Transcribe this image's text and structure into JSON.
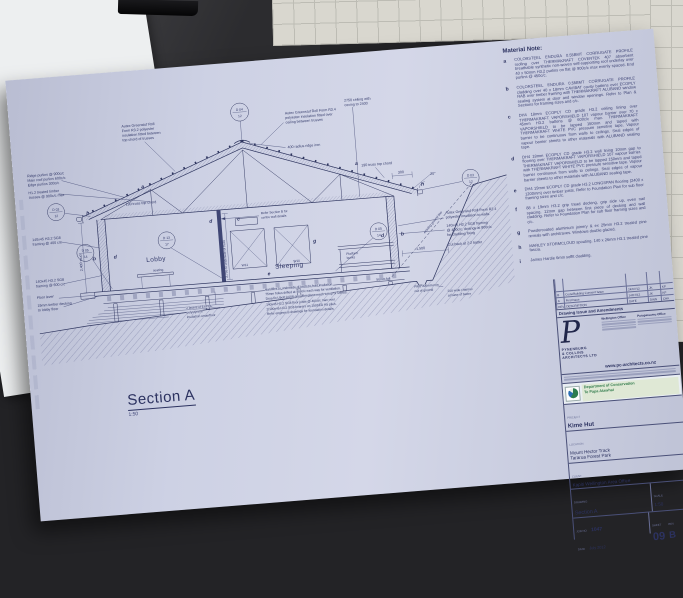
{
  "sheet": {
    "material_note": {
      "title": "Material Note:",
      "items": [
        {
          "key": "a",
          "text": "COLORSTEEL ENDURA 0.55BMT CORRUGATE PROFILE roofing over THERMAKRAFT COVERTEK 407 absorbent breathable synthetic non-woven self-supporting roof underlay over 40 x 50mm H3.2 purlins on flat @ 900c/c max evenly spaced. End purlins @ 450c/c."
        },
        {
          "key": "b",
          "text": "COLORSTEEL ENDURA 0.55BMT CORRUGATE PROFILE cladding over 40 x 18mm CAVIBAT cavity battens over ECOPLY RAB over timber framing with THERMAKRAFT ALUBAND window sealing system at door and window openings. Refer to Plan & Sections for framing sizes and c/c."
        },
        {
          "key": "c",
          "text": "DH4 18mm ECOPLY CD grade H3.2 ceiling lining over THERMAKRAFT VAPORSHIELD 107 vapour barrier over 70 x 45mm H3.2 battens @ 600c/c max. THERMAKRAFT VAPORSHIELD to be lapped 150mm and taped with THERMAKRAFT WHITE PVC pressure sensitive tape. Vapour barrier to be continuous from walls to ceilings. Seal edges of vapour barrier sheets to other materials with ALUBAND sealing tape."
        },
        {
          "key": "d",
          "text": "DH4 18mm ECOPLY CD grade H3.2 wall lining 10mm gap to flooring over THERMAKRAFT VAPORSHIELD 107 vapour barrier. THERMAKRAFT VAPORSHIELD to be lapped 150mm and taped with THERMAKRAFT WHITE PVC pressure sensitive tape. Vapour barrier continuous from walls to ceilings. Seal edges of vapour barrier sheets to other materials with ALUBAND sealing tape."
        },
        {
          "key": "e",
          "text": "DH4 19mm ECOPLY CD grade H3.2 LONGSPAN flooring (2400 x 1200mm) over timber joists. Refer to Foundation Plan for sub floor framing sizes and c/c."
        },
        {
          "key": "f",
          "text": "88 x 19mm H3.2 grip tread decking, grip side up, even nail spacing. 12mm gap between first piece of decking and wall cladding. Refer to Foundation Plan for sub floor framing sizes and c/c."
        },
        {
          "key": "g",
          "text": "Powdercoated aluminium joinery & ex 25mm H3.2 treated pine reveals with architraves. Windows double glazed."
        },
        {
          "key": "h",
          "text": "MARLEY STORMCLOUD spouting. 140 x 26mm H3.1 treated pine fascia."
        },
        {
          "key": "i",
          "text": "James Hardie 6mm soffit cladding."
        }
      ]
    },
    "drawing": {
      "section_title": "Section A",
      "section_scale": "1:50",
      "rooms": {
        "lobby": "Lobby",
        "sleeping": "Sleeping",
        "seating": "seating",
        "bunks": [
          "Platform",
          "bunks"
        ]
      },
      "windows": {
        "w11": "W11",
        "w10": "W10"
      },
      "letters": {
        "a": "a",
        "b": "b",
        "c": "c",
        "d": "d",
        "e": "e",
        "g": "g",
        "h": "h"
      },
      "circles": [
        {
          "top": "D 04",
          "bot": "12"
        },
        {
          "top": "D 03",
          "bot": "12"
        },
        {
          "top": "D 03",
          "bot": "12"
        },
        {
          "top": "D 05",
          "bot": "14"
        },
        {
          "top": "D 13",
          "bot": "17"
        },
        {
          "top": "D 05",
          "bot": "14"
        }
      ],
      "callouts": {
        "ridge_purlins": [
          "Ridge purlins @ 900c/c",
          "Main roof purlins 600c/c",
          "Edge purlins 300c/c"
        ],
        "trusses": [
          "H1.2 treated timber",
          "trusses @ 900c/c max"
        ],
        "truss_chord_left": "190 truss top chord",
        "truss_chord_right": "190 truss top chord",
        "framing400": [
          "140x45 H3.2 SG8",
          "framing @ 400 c/c"
        ],
        "framing600": [
          "140x45 H3.2 SG8",
          "framing @ 600 c/c"
        ],
        "floor_level": "Floor level",
        "decking": [
          "19mm timber decking",
          "to lobby floor"
        ],
        "insul_top_left": [
          "Autex Greenstuf Roll",
          "Form R3.2 polyester",
          "insulation fitted between",
          "top chord of trusses"
        ],
        "insul_top_right": [
          "Autex Greenstuf Roll Form R3.4",
          "polyester insulation fitted over",
          "ceiling between trusses"
        ],
        "ridge_iron": "400 radius ridge iron",
        "ceiling_note": [
          "2750 ceiling with",
          "coving to 2400"
        ],
        "insul_walls": [
          "Autex Greenstuf Roll Form R2.4",
          "polyester insulation to walls"
        ],
        "framing_cladding": [
          "140x45 H3.2 SG8 framing",
          "@ 400c/c, dwangs at 800c/c",
          "for cladding fixing"
        ],
        "cutback": "Cut back at 2:2 batter",
        "existing_ground": "existing ground line",
        "fall": "50mm fall",
        "piles_note": [
          "Piles 300mm min",
          "out of ground"
        ],
        "channel": [
          "200 wide channel",
          "at base of batter"
        ],
        "refer_b": [
          "Refer Section B for",
          "centre wall details"
        ],
        "expol": [
          "2 layers of EXPOL",
          "polystyrene",
          "insulation underfloor"
        ],
        "bottom_notes": [
          "Hardiflex to underside of joists to hold insulation.",
          "75mm holes drilled at 400c/c each way for ventilation.",
          "Drua fix Ubolt 0.008 grey fibreglass mesh to top of sheets.",
          "140x45 H3.2 SG8 floor joists @ 400c/c max over",
          "2/190x45 H3.2 SG8 bearers on 150SED H5 piles.",
          "Refer engineers drawings for foundation details."
        ]
      },
      "dims": {
        "stud": "2,400 stud",
        "truss": "2,755 to underside of truss",
        "m1500": "1,500",
        "m300": "300",
        "pitch": "20°"
      }
    },
    "title_block": {
      "rev_header": [
        "REV",
        "DESCRIPTION",
        "DATE",
        "DWN",
        "CHK"
      ],
      "revisions": [
        {
          "rev": "B",
          "desc": "Code/Building Consent Issue",
          "date": "24/07/12",
          "by": "JK",
          "chk": "KP"
        },
        {
          "rev": "A",
          "desc": "First Issue",
          "date": "14/07/12",
          "by": "JK",
          "chk": "KP"
        }
      ],
      "rev_caption": "Drawing Issue and Amendments",
      "firm": {
        "initial": "P",
        "name1": "PYNENBURG",
        "name2": "& COLLINS",
        "name3": "ARCHITECTS LTD",
        "office1": "Wellington Office",
        "office2": "Paraparaumu Office",
        "website": "www.pc-architects.co.nz"
      },
      "doc": {
        "line1": "Department of Conservation",
        "line2": "Te Papa Atawhai"
      },
      "labels": {
        "project": "PROJECT",
        "location": "LOCATION",
        "client": "CLIENT",
        "drawing": "DRAWING",
        "scale": "SCALE",
        "job": "JOB No",
        "sheet": "SHEET",
        "rev": "REV",
        "date": "DATE"
      },
      "project": "Kime Hut",
      "location1": "Mount Hector Track",
      "location2": "Tararua Forest Park",
      "client": "Kapiti Wellington Area Office",
      "drawing": "Section A",
      "scale": "1:50",
      "job": "1047",
      "sheet_no": "09",
      "rev": "B",
      "date": "July 2012"
    }
  }
}
